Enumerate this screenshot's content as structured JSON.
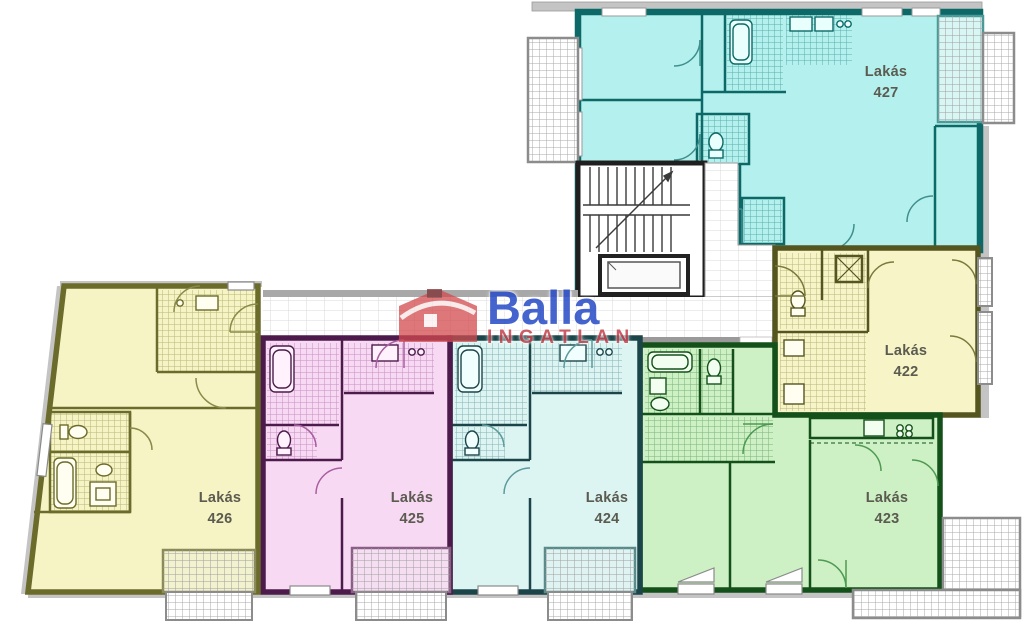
{
  "watermark": {
    "brand": "Balla",
    "subtitle": "INGATLAN",
    "brand_color": "#2c4fc7",
    "subtitle_color": "#c64751",
    "house_icon_color": "#d2494e"
  },
  "apartments": [
    {
      "name": "Lakás",
      "number": "427",
      "fill": "#b4f1ee",
      "wall": "#0d6968"
    },
    {
      "name": "Lakás",
      "number": "422",
      "fill": "#f7f5c8",
      "wall": "#55551f"
    },
    {
      "name": "Lakás",
      "number": "423",
      "fill": "#cdf0c4",
      "wall": "#14511a"
    },
    {
      "name": "Lakás",
      "number": "424",
      "fill": "#dcf5f3",
      "wall": "#1c454a"
    },
    {
      "name": "Lakás",
      "number": "425",
      "fill": "#f8d9f4",
      "wall": "#4c1b4c"
    },
    {
      "name": "Lakás",
      "number": "426",
      "fill": "#f6f4c4",
      "wall": "#6b6b2b"
    }
  ],
  "common_areas": {
    "label_color": "#5b5b50"
  }
}
